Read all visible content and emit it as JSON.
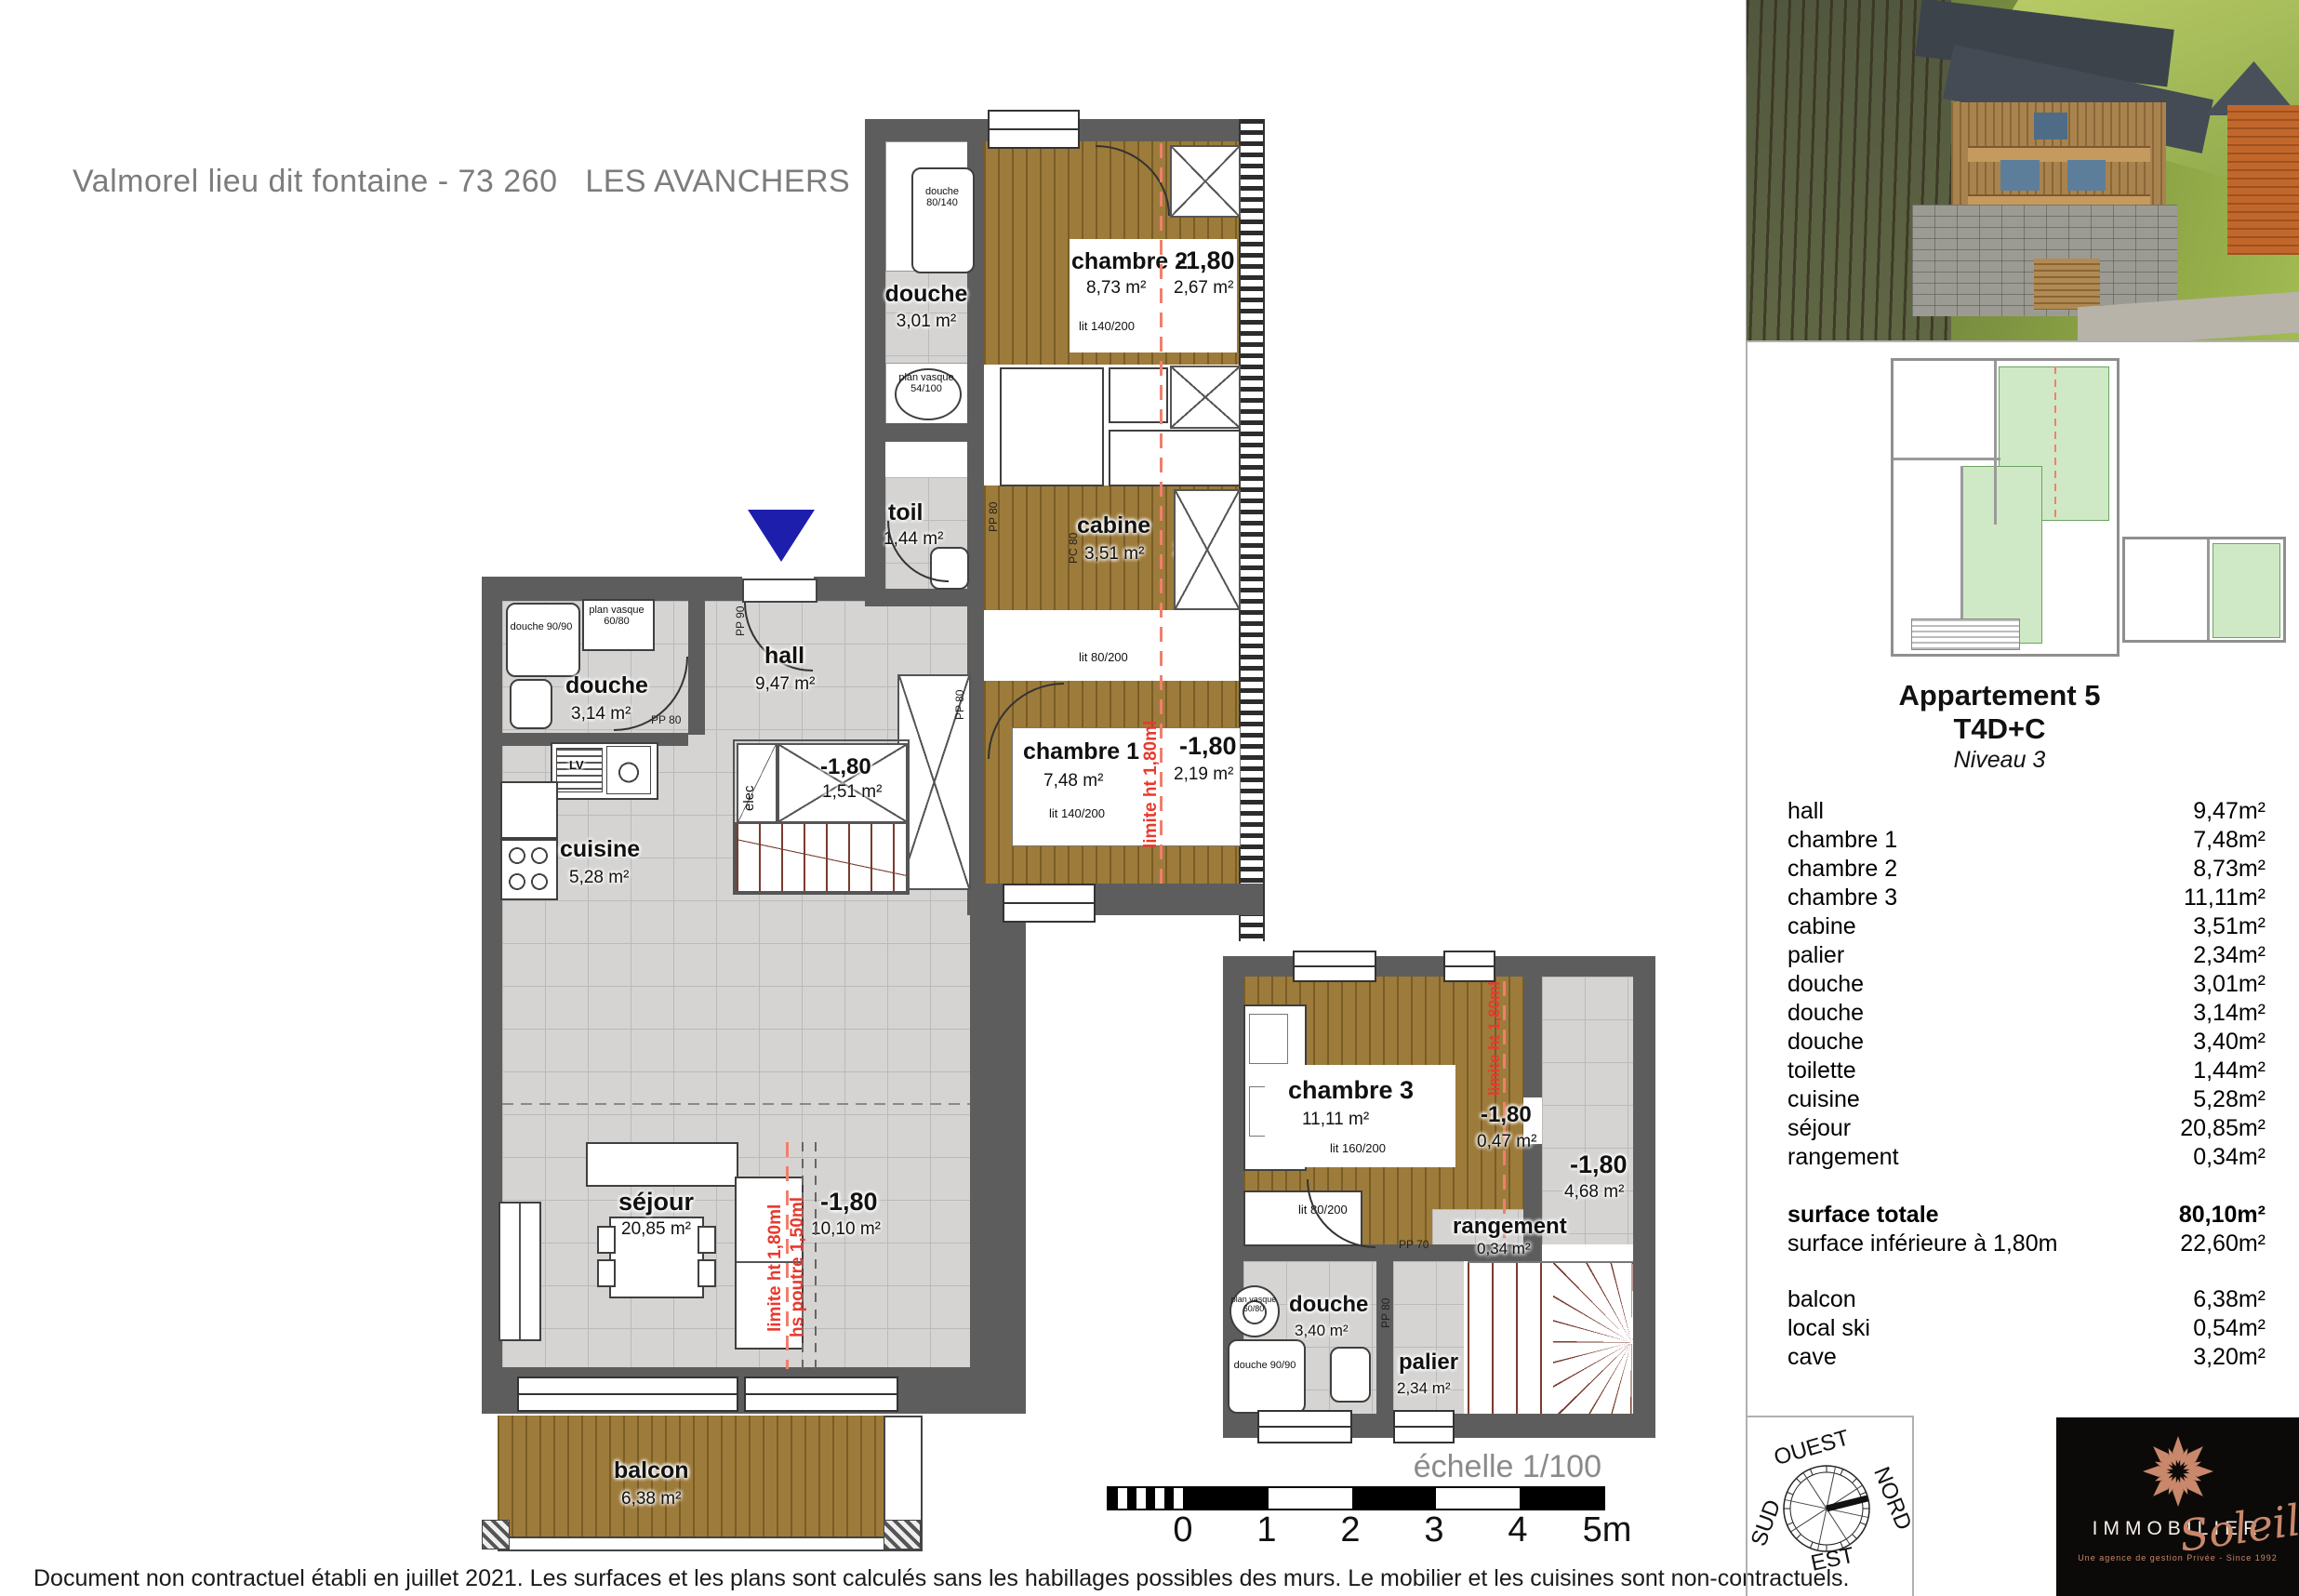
{
  "title": "Valmorel lieu dit fontaine - 73 260   LES AVANCHERS",
  "disclaimer": "Document non contractuel établi en juillet 2021. Les surfaces et les plans sont calculés sans les habillages possibles des murs. Le mobilier et les cuisines sont non-contractuels.",
  "scale_bar": {
    "caption": "échelle 1/100",
    "ticks": [
      "0",
      "1",
      "2",
      "3",
      "4",
      "5m"
    ]
  },
  "plan_upper": {
    "chambre2": {
      "name": "chambre 2",
      "area": "8,73 m²",
      "low_label": "-1,80",
      "low_area": "2,67 m²",
      "bed": "lit 140/200"
    },
    "cabine": {
      "name": "cabine",
      "area": "3,51 m²",
      "low_label": "-1,80",
      "low_area": "2,49 m²",
      "bed": "lit 80/200"
    },
    "chambre1": {
      "name": "chambre 1",
      "area": "7,48 m²",
      "low_label": "-1,80",
      "low_area": "2,19 m²",
      "bed": "lit 140/200",
      "limit_note": "limite ht 1,80ml"
    },
    "douche_haut": {
      "name": "douche",
      "area": "3,01 m²",
      "tray": "douche 80/140",
      "vasque": "plan vasque 54/100"
    },
    "toilette": {
      "name": "toil",
      "area": "1,44 m²"
    },
    "hall": {
      "name": "hall",
      "area": "9,47 m²"
    },
    "placard": {
      "low_label": "-1,80",
      "low_area": "1,51 m²",
      "elec": "elec"
    },
    "doors": {
      "pp80": "PP 80",
      "pp90": "PP 90",
      "pc80": "PC 80"
    }
  },
  "plan_lower": {
    "douche_gauche": {
      "name": "douche",
      "area": "3,14 m²",
      "tray": "douche 90/90",
      "vasque": "plan vasque 60/80",
      "lv": "LV"
    },
    "cuisine": {
      "name": "cuisine",
      "area": "5,28 m²"
    },
    "sejour": {
      "name": "séjour",
      "area": "20,85 m²",
      "low_label": "-1,80",
      "low_area": "10,10 m²",
      "limit_note": "limite ht 1,80ml",
      "beam_note": "hs poutre 1,50ml"
    },
    "balcon": {
      "name": "balcon",
      "area": "6,38 m²"
    }
  },
  "plan_niveau2": {
    "chambre3": {
      "name": "chambre 3",
      "area": "11,11 m²",
      "bed1": "lit 160/200",
      "bed2": "lit 80/200",
      "limit_note": "limite ht 1,80ml",
      "low_label": "-1,80",
      "low_area": "0,47 m²"
    },
    "degagement": {
      "low_label": "-1,80",
      "low_area": "4,68 m²"
    },
    "rangement": {
      "name": "rangement",
      "area": "0,34 m²",
      "door": "PP 70"
    },
    "douche": {
      "name": "douche",
      "area": "3,40 m²",
      "tray": "douche 90/90",
      "vasque": "plan vasque 60/80"
    },
    "palier": {
      "name": "palier",
      "area": "2,34 m²",
      "door": "PP 80"
    }
  },
  "sidebar": {
    "apartment": "Appartement 5",
    "type": "T4D+C",
    "level": "Niveau 3",
    "rooms": [
      {
        "label": "hall",
        "area": "9,47m²"
      },
      {
        "label": "chambre 1",
        "area": "7,48m²"
      },
      {
        "label": "chambre 2",
        "area": "8,73m²"
      },
      {
        "label": "chambre 3",
        "area": "11,11m²"
      },
      {
        "label": "cabine",
        "area": "3,51m²"
      },
      {
        "label": "palier",
        "area": "2,34m²"
      },
      {
        "label": "douche",
        "area": "3,01m²"
      },
      {
        "label": "douche",
        "area": "3,14m²"
      },
      {
        "label": "douche",
        "area": "3,40m²"
      },
      {
        "label": "toilette",
        "area": "1,44m²"
      },
      {
        "label": "cuisine",
        "area": "5,28m²"
      },
      {
        "label": "séjour",
        "area": "20,85m²"
      },
      {
        "label": "rangement",
        "area": "0,34m²"
      }
    ],
    "totals": {
      "total_label": "surface totale",
      "total_area": "80,10m²",
      "under_label": "surface inférieure à 1,80m",
      "under_area": "22,60m²"
    },
    "annexes": [
      {
        "label": "balcon",
        "area": "6,38m²"
      },
      {
        "label": "local ski",
        "area": "0,54m²"
      },
      {
        "label": "cave",
        "area": "3,20m²"
      }
    ],
    "compass": {
      "west": "OUEST",
      "north": "NORD",
      "south": "SUD",
      "east": "EST"
    },
    "logo": {
      "brand": "IMMOBILIER",
      "script": "Soleil",
      "tagline": "Une agence de gestion Privée - Since 1992"
    }
  },
  "colors": {
    "wood": "#9d7b3b",
    "tile": "#d6d4d2",
    "wall": "#5d5d5d",
    "limit_red": "#e8392e",
    "entry_blue": "#1e1ead",
    "keyplan_green": "#cfe9c6",
    "logo_copper": "#c9886b"
  }
}
